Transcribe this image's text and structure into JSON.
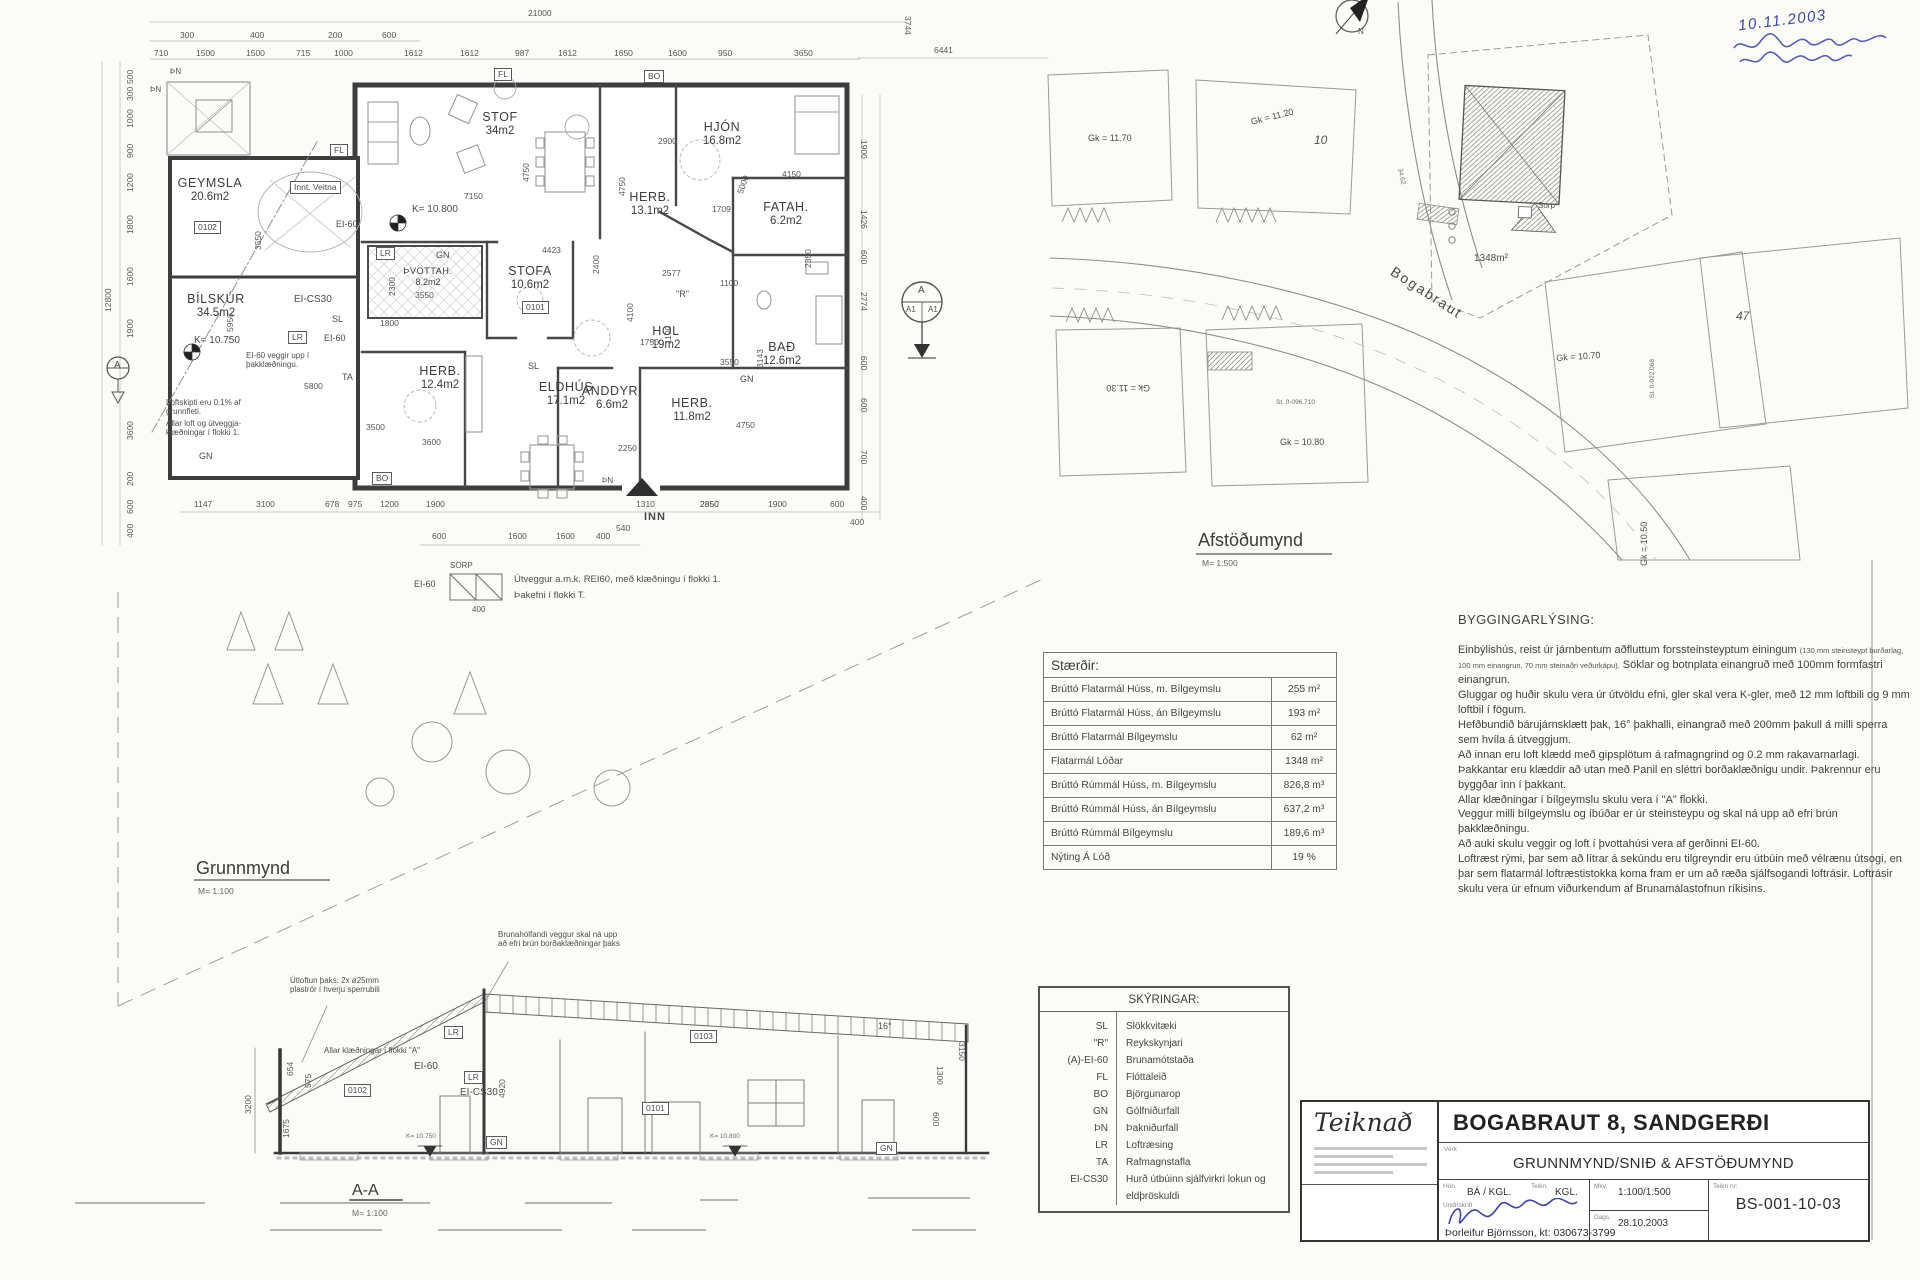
{
  "floor_plan": {
    "title": "Grunnmynd",
    "scale": "M= 1:100",
    "rooms": [
      {
        "name": "STOF",
        "area": "34m2",
        "x": 500,
        "y": 110
      },
      {
        "name": "HJÓN",
        "area": "16.8m2",
        "x": 722,
        "y": 120
      },
      {
        "name": "HERB.",
        "area": "13.1m2",
        "x": 650,
        "y": 190
      },
      {
        "name": "FATAH.",
        "area": "6.2m2",
        "x": 786,
        "y": 200
      },
      {
        "name": "GEYMSLA",
        "area": "20.6m2",
        "x": 210,
        "y": 176
      },
      {
        "name": "ÞVOTTAH.",
        "area": "8.2m2",
        "x": 428,
        "y": 266,
        "cls": "rsm"
      },
      {
        "name": "STOFA",
        "area": "10.6m2",
        "x": 530,
        "y": 264
      },
      {
        "name": "HOL",
        "area": "19m2",
        "x": 666,
        "y": 324
      },
      {
        "name": "BAÐ",
        "area": "12.6m2",
        "x": 782,
        "y": 340
      },
      {
        "name": "BÍLSKÚR",
        "area": "34.5m2",
        "x": 216,
        "y": 292
      },
      {
        "name": "HERB.",
        "area": "12.4m2",
        "x": 440,
        "y": 364
      },
      {
        "name": "ELDHÚS",
        "area": "17.1m2",
        "x": 566,
        "y": 380
      },
      {
        "name": "ANDDYRI",
        "area": "6.6m2",
        "x": 612,
        "y": 384
      },
      {
        "name": "HERB.",
        "area": "11.8m2",
        "x": 692,
        "y": 396
      }
    ],
    "labels": [
      {
        "t": "Innt. Veitna",
        "x": 290,
        "y": 181,
        "cls": "boxed"
      },
      {
        "t": "EI-60",
        "x": 336,
        "y": 220
      },
      {
        "t": "K= 10.800",
        "x": 412,
        "y": 205,
        "cls": "md"
      },
      {
        "t": "K= 10.750",
        "x": 194,
        "y": 336,
        "cls": "md"
      },
      {
        "t": "LR",
        "x": 376,
        "y": 247,
        "cls": "boxed"
      },
      {
        "t": "GN",
        "x": 436,
        "y": 251
      },
      {
        "t": "EI-CS30",
        "x": 294,
        "y": 295,
        "cls": "md"
      },
      {
        "t": "SL",
        "x": 332,
        "y": 315
      },
      {
        "t": "LR",
        "x": 288,
        "y": 331,
        "cls": "boxed"
      },
      {
        "t": "EI-60",
        "x": 324,
        "y": 334
      },
      {
        "t": "TA",
        "x": 342,
        "y": 373
      },
      {
        "t": "GN",
        "x": 199,
        "y": 452
      },
      {
        "t": "SL",
        "x": 528,
        "y": 362
      },
      {
        "t": "GN",
        "x": 740,
        "y": 375
      },
      {
        "t": "\"R\"",
        "x": 676,
        "y": 290
      },
      {
        "t": "FL",
        "x": 494,
        "y": 68,
        "cls": "boxed"
      },
      {
        "t": "FL",
        "x": 330,
        "y": 144,
        "cls": "boxed"
      },
      {
        "t": "BO",
        "x": 644,
        "y": 70,
        "cls": "boxed"
      },
      {
        "t": "BO",
        "x": 372,
        "y": 472,
        "cls": "boxed"
      },
      {
        "t": "ÞN",
        "x": 170,
        "y": 68,
        "cls": "tiny2"
      },
      {
        "t": "ÞN",
        "x": 150,
        "y": 86,
        "cls": "tiny2"
      },
      {
        "t": "ÞN",
        "x": 602,
        "y": 477,
        "cls": "tiny2"
      },
      {
        "t": "INN",
        "x": 644,
        "y": 512,
        "cls": "big"
      },
      {
        "t": "SORP",
        "x": 450,
        "y": 562,
        "cls": "tiny2"
      },
      {
        "t": "EI-60",
        "x": 414,
        "y": 580
      },
      {
        "t": "400",
        "x": 472,
        "y": 606,
        "cls": "tiny2"
      },
      {
        "t": "0102",
        "x": 194,
        "y": 221,
        "cls": "boxed"
      },
      {
        "t": "0101",
        "x": 522,
        "y": 301,
        "cls": "boxed"
      }
    ],
    "notes": [
      {
        "t": "EI-60 veggir upp í þakklæðningu.",
        "x": 246,
        "y": 351,
        "w": 88
      },
      {
        "t": "Loftskipti eru 0.1% af grunnfleti.",
        "x": 166,
        "y": 398,
        "w": 104
      },
      {
        "t": "Allar loft og útveggja- klæðningar í flokki 1.",
        "x": 166,
        "y": 419,
        "w": 104
      },
      {
        "t": "Útveggur a.m.k. REI60, með klæðningu í flokki 1.",
        "x": 514,
        "y": 574,
        "w": 230,
        "cls": "md"
      },
      {
        "t": "Þakefni í flokki T.",
        "x": 514,
        "y": 590,
        "w": 230,
        "cls": "md"
      }
    ],
    "dims": [
      {
        "t": "21000",
        "x": 528,
        "y": 9
      },
      {
        "t": "3744",
        "x": 912,
        "y": 16,
        "rot": 90
      },
      {
        "t": "6441",
        "x": 934,
        "y": 46
      },
      {
        "t": "300",
        "x": 180,
        "y": 31
      },
      {
        "t": "400",
        "x": 250,
        "y": 31
      },
      {
        "t": "200",
        "x": 328,
        "y": 31
      },
      {
        "t": "600",
        "x": 382,
        "y": 31
      },
      {
        "t": "710",
        "x": 154,
        "y": 49
      },
      {
        "t": "1500",
        "x": 196,
        "y": 49
      },
      {
        "t": "1500",
        "x": 246,
        "y": 49
      },
      {
        "t": "715",
        "x": 296,
        "y": 49
      },
      {
        "t": "1000",
        "x": 334,
        "y": 49
      },
      {
        "t": "1612",
        "x": 404,
        "y": 49
      },
      {
        "t": "1612",
        "x": 460,
        "y": 49
      },
      {
        "t": "987",
        "x": 515,
        "y": 49
      },
      {
        "t": "1612",
        "x": 558,
        "y": 49
      },
      {
        "t": "1650",
        "x": 614,
        "y": 49
      },
      {
        "t": "1600",
        "x": 668,
        "y": 49
      },
      {
        "t": "950",
        "x": 718,
        "y": 49
      },
      {
        "t": "3650",
        "x": 794,
        "y": 49
      },
      {
        "t": "500",
        "x": 126,
        "y": 84,
        "rot": -90
      },
      {
        "t": "300",
        "x": 126,
        "y": 101,
        "rot": -90
      },
      {
        "t": "1000",
        "x": 126,
        "y": 128,
        "rot": -90
      },
      {
        "t": "900",
        "x": 126,
        "y": 158,
        "rot": -90
      },
      {
        "t": "1200",
        "x": 126,
        "y": 192,
        "rot": -90
      },
      {
        "t": "1800",
        "x": 126,
        "y": 234,
        "rot": -90
      },
      {
        "t": "1600",
        "x": 126,
        "y": 286,
        "rot": -90
      },
      {
        "t": "1900",
        "x": 126,
        "y": 338,
        "rot": -90
      },
      {
        "t": "3600",
        "x": 126,
        "y": 440,
        "rot": -90
      },
      {
        "t": "200",
        "x": 126,
        "y": 486,
        "rot": -90
      },
      {
        "t": "600",
        "x": 126,
        "y": 514,
        "rot": -90
      },
      {
        "t": "400",
        "x": 126,
        "y": 538,
        "rot": -90
      },
      {
        "t": "12800",
        "x": 104,
        "y": 312,
        "rot": -90
      },
      {
        "t": "1900",
        "x": 868,
        "y": 140,
        "rot": 90
      },
      {
        "t": "1426",
        "x": 868,
        "y": 210,
        "rot": 90
      },
      {
        "t": "600",
        "x": 868,
        "y": 250,
        "rot": 90
      },
      {
        "t": "2774",
        "x": 868,
        "y": 292,
        "rot": 90
      },
      {
        "t": "600",
        "x": 868,
        "y": 356,
        "rot": 90
      },
      {
        "t": "600",
        "x": 868,
        "y": 398,
        "rot": 90
      },
      {
        "t": "700",
        "x": 868,
        "y": 450,
        "rot": 90
      },
      {
        "t": "400",
        "x": 868,
        "y": 496,
        "rot": 90
      },
      {
        "t": "1147",
        "x": 194,
        "y": 500
      },
      {
        "t": "3100",
        "x": 256,
        "y": 500
      },
      {
        "t": "678",
        "x": 325,
        "y": 500
      },
      {
        "t": "975",
        "x": 348,
        "y": 500
      },
      {
        "t": "1200",
        "x": 380,
        "y": 500
      },
      {
        "t": "1900",
        "x": 426,
        "y": 500
      },
      {
        "t": "1310",
        "x": 636,
        "y": 500
      },
      {
        "t": "2850",
        "x": 700,
        "y": 500
      },
      {
        "t": "1900",
        "x": 768,
        "y": 500
      },
      {
        "t": "600",
        "x": 830,
        "y": 500
      },
      {
        "t": "400",
        "x": 850,
        "y": 518
      },
      {
        "t": "600",
        "x": 432,
        "y": 532
      },
      {
        "t": "1600",
        "x": 508,
        "y": 532
      },
      {
        "t": "1600",
        "x": 556,
        "y": 532
      },
      {
        "t": "400",
        "x": 596,
        "y": 532
      },
      {
        "t": "540",
        "x": 616,
        "y": 524
      },
      {
        "t": "7150",
        "x": 464,
        "y": 192
      },
      {
        "t": "4423",
        "x": 542,
        "y": 246
      },
      {
        "t": "2900",
        "x": 658,
        "y": 137
      },
      {
        "t": "4150",
        "x": 782,
        "y": 170
      },
      {
        "t": "1709",
        "x": 712,
        "y": 205
      },
      {
        "t": "2577",
        "x": 662,
        "y": 269
      },
      {
        "t": "1100",
        "x": 720,
        "y": 279
      },
      {
        "t": "3550",
        "x": 720,
        "y": 358
      },
      {
        "t": "3550",
        "x": 415,
        "y": 291
      },
      {
        "t": "1800",
        "x": 380,
        "y": 319
      },
      {
        "t": "1750",
        "x": 640,
        "y": 338
      },
      {
        "t": "3600",
        "x": 422,
        "y": 438
      },
      {
        "t": "2250",
        "x": 618,
        "y": 444
      },
      {
        "t": "3500",
        "x": 366,
        "y": 423
      },
      {
        "t": "5800",
        "x": 304,
        "y": 382
      },
      {
        "t": "4750",
        "x": 736,
        "y": 421
      },
      {
        "t": "2850",
        "x": 700,
        "y": 500
      },
      {
        "t": "4750",
        "x": 522,
        "y": 182,
        "rot": -90
      },
      {
        "t": "4750",
        "x": 618,
        "y": 196,
        "rot": -90
      },
      {
        "t": "5000",
        "x": 736,
        "y": 192,
        "rot": -70
      },
      {
        "t": "2350",
        "x": 804,
        "y": 268,
        "rot": -90
      },
      {
        "t": "2300",
        "x": 388,
        "y": 296,
        "rot": -90
      },
      {
        "t": "4100",
        "x": 626,
        "y": 322,
        "rot": -90
      },
      {
        "t": "1100",
        "x": 664,
        "y": 344,
        "rot": -90
      },
      {
        "t": "3143",
        "x": 756,
        "y": 368,
        "rot": -90
      },
      {
        "t": "2400",
        "x": 592,
        "y": 274,
        "rot": -90
      },
      {
        "t": "5950",
        "x": 226,
        "y": 332,
        "rot": -90
      },
      {
        "t": "3550",
        "x": 254,
        "y": 250,
        "rot": -90
      }
    ]
  },
  "site_plan": {
    "title": "Afstöðumynd",
    "scale": "M= 1:500",
    "labels": [
      {
        "t": "Gk = 11.70",
        "x": 1088,
        "y": 134
      },
      {
        "t": "Gk = 11.20",
        "x": 1250,
        "y": 118,
        "rot": -14
      },
      {
        "t": "10",
        "x": 1314,
        "y": 134,
        "cls": "ital"
      },
      {
        "t": "Gk = 11.30",
        "x": 1150,
        "y": 392,
        "rot": 180
      },
      {
        "t": "Gk = 10.80",
        "x": 1280,
        "y": 438
      },
      {
        "t": "Gk = 10.70",
        "x": 1556,
        "y": 354,
        "rot": -4
      },
      {
        "t": "47",
        "x": 1736,
        "y": 310,
        "cls": "ital"
      },
      {
        "t": "Gk = 10.50",
        "x": 1640,
        "y": 566,
        "rot": -90
      },
      {
        "t": "Bogabraut",
        "x": 1396,
        "y": 264,
        "rot": 33,
        "cls": "street"
      },
      {
        "t": "1348m²",
        "x": 1474,
        "y": 254,
        "cls": "md"
      },
      {
        "t": "Sorp",
        "x": 1538,
        "y": 202,
        "cls": "tiny2"
      },
      {
        "t": "St. 0-096.710",
        "x": 1276,
        "y": 400,
        "cls": "tiny"
      },
      {
        "t": "St. 0-022.068",
        "x": 1650,
        "y": 398,
        "rot": -90,
        "cls": "tiny"
      },
      {
        "t": "34.62",
        "x": 1402,
        "y": 168,
        "rot": 78,
        "cls": "tiny"
      },
      {
        "t": "N",
        "x": 1358,
        "y": 28,
        "cls": "tiny2"
      },
      {
        "t": "A",
        "x": 918,
        "y": 286,
        "cls": "md"
      },
      {
        "t": "A1",
        "x": 906,
        "y": 306,
        "cls": "tiny2"
      },
      {
        "t": "A1",
        "x": 928,
        "y": 306,
        "cls": "tiny2"
      },
      {
        "t": "A",
        "x": 114,
        "y": 361,
        "cls": "md"
      }
    ]
  },
  "section": {
    "title": "A-A",
    "scale": "M= 1:100",
    "labels": [
      {
        "t": "EI-60",
        "x": 414,
        "y": 1062,
        "cls": "md"
      },
      {
        "t": "LR",
        "x": 464,
        "y": 1071,
        "cls": "boxed"
      },
      {
        "t": "EI-CS30",
        "x": 460,
        "y": 1088,
        "cls": "md"
      },
      {
        "t": "LR",
        "x": 444,
        "y": 1026,
        "cls": "boxed"
      },
      {
        "t": "GN",
        "x": 486,
        "y": 1136,
        "cls": "boxed"
      },
      {
        "t": "GN",
        "x": 876,
        "y": 1142,
        "cls": "boxed"
      },
      {
        "t": "0103",
        "x": 690,
        "y": 1030,
        "cls": "boxed"
      },
      {
        "t": "0102",
        "x": 344,
        "y": 1084,
        "cls": "boxed"
      },
      {
        "t": "0101",
        "x": 642,
        "y": 1102,
        "cls": "boxed"
      },
      {
        "t": "16°",
        "x": 878,
        "y": 1022
      },
      {
        "t": "K= 10.750",
        "x": 406,
        "y": 1134,
        "cls": "tiny"
      },
      {
        "t": "K= 10.800",
        "x": 710,
        "y": 1134,
        "cls": "tiny"
      }
    ],
    "notes": [
      {
        "t": "Brunahólfandi veggur skal ná upp að efri brún borðaklæðningar þaks",
        "x": 498,
        "y": 930,
        "w": 122
      },
      {
        "t": "Útloftun þaks: 2x ø25mm plaströr í hverju sperrubili",
        "x": 290,
        "y": 976,
        "w": 106
      },
      {
        "t": "Allar klæðningar í flokki \"A\"",
        "x": 324,
        "y": 1046,
        "w": 170
      }
    ],
    "dims": [
      {
        "t": "3200",
        "x": 244,
        "y": 1114,
        "rot": -90
      },
      {
        "t": "654",
        "x": 286,
        "y": 1076,
        "rot": -90
      },
      {
        "t": "575",
        "x": 304,
        "y": 1088,
        "rot": -90
      },
      {
        "t": "1675",
        "x": 282,
        "y": 1138,
        "rot": -90
      },
      {
        "t": "4920",
        "x": 498,
        "y": 1098,
        "rot": -90
      },
      {
        "t": "3150",
        "x": 966,
        "y": 1042,
        "rot": 90
      },
      {
        "t": "1300",
        "x": 944,
        "y": 1066,
        "rot": 90
      },
      {
        "t": "600",
        "x": 940,
        "y": 1112,
        "rot": 90
      }
    ]
  },
  "size_table": {
    "title": "Stærðir:",
    "rows": [
      {
        "label": "Brúttó Flatarmál Húss, m. Bílgeymslu",
        "value": "255 m²"
      },
      {
        "label": "Brúttó Flatarmál Húss, án Bílgeymslu",
        "value": "193 m²"
      },
      {
        "label": "Brúttó Flatarmál Bílgeymslu",
        "value": "62 m²"
      },
      {
        "label": "Flatarmál Lóðar",
        "value": "1348 m²"
      },
      {
        "label": "Brúttó Rúmmál Húss, m. Bílgeymslu",
        "value": "826,8 m³"
      },
      {
        "label": "Brúttó Rúmmál Húss, án Bílgeymslu",
        "value": "637,2 m³"
      },
      {
        "label": "Brúttó Rúmmál Bílgeymslu",
        "value": "189,6 m³"
      },
      {
        "label": "Nýting Á Lóð",
        "value": "19 %"
      }
    ]
  },
  "legend": {
    "title": "SKÝRINGAR:",
    "rows": [
      {
        "code": "SL",
        "meaning": "Slökkvitæki"
      },
      {
        "code": "\"R\"",
        "meaning": "Reykskynjari"
      },
      {
        "code": "(A)-EI-60",
        "meaning": "Brunamótstaða"
      },
      {
        "code": "FL",
        "meaning": "Flóttaleið"
      },
      {
        "code": "BO",
        "meaning": "Björgunarop"
      },
      {
        "code": "GN",
        "meaning": "Gólfniðurfall"
      },
      {
        "code": "ÞN",
        "meaning": "Þakniðurfall"
      },
      {
        "code": "LR",
        "meaning": "Loftræsing"
      },
      {
        "code": "TA",
        "meaning": "Rafmagnstafla"
      },
      {
        "code": "EI-CS30",
        "meaning": "Hurð útbúinn sjálfvirkri lokun og eldþröskuldi"
      }
    ]
  },
  "building_description": {
    "title": "BYGGINGARLÝSING:",
    "intro": [
      "Einbýlishús, reist úr járnbentum aðfluttum forssteinsteyptum einingum ",
      "(130 mm steinsteypt burðarlag, 100 mm einangrun, 70 mm steinaðri veðurkápu).",
      "  Söklar og botnplata einangruð með 100mm formfastri einangrun."
    ],
    "paragraphs": [
      "Gluggar og huðir skulu vera úr útvöldu efni, gler skal vera K-gler, með 12 mm loftbili og 9 mm loftbil í fögum.",
      "Hefðbundið bárujárnsklætt þak, 16° þakhalli, einangrað með 200mm þakull á milli sperra sem hvíla á útveggjum.",
      "Að innan eru loft klædd með gipsplötum á rafmagngrind og 0.2 mm rakavarnarlagi.",
      "Þakkantar eru klæddir að utan með Panil en sléttri borðaklæðnigu undir. Þakrennur eru byggðar inn í þakkant.",
      "Allar klæðningar í bílgeymslu skulu vera í \"A\" flokki.",
      "Veggur milli bílgeymslu og íbúðar er úr steinsteypu og skal ná upp að efri brún þakklæðningu.",
      "Að auki skulu veggir og loft í þvottahúsi vera af gerðinni EI-60.",
      "Loftræst rými, þar sem að lítrar á sekúndu eru tilgreyndir eru útbúin með vélrænu útsogi, en þar sem flatarmál loftræstistokka koma fram er um að ræða sjálfsogandi loftrásir.  Loftrásir skulu vera úr efnum viðurkendum af Brunamálastofnun ríkisins."
    ]
  },
  "title_block": {
    "company": "Teiknað",
    "project": "BOGABRAUT 8, SANDGERÐI",
    "verk_label": "Verk",
    "drawing_title": "GRUNNMYND/SNIÐ & AFSTÖÐUMYND",
    "hon_label": "Hön.",
    "hon": "BÁ / KGL.",
    "teikn_label": "Teikn.",
    "teikn": "KGL.",
    "mkv_label": "Mkv.",
    "mkv": "1:100/1:500",
    "dags_label": "Dags.",
    "dags": "28.10.2003",
    "number_label": "Teikn nr:",
    "number": "BS-001-10-03",
    "undirskrift_label": "Undirskrift",
    "signer": "Þorleifur Björnsson, kt: 030673-3799"
  },
  "handwriting": {
    "date": "10.11.2003"
  }
}
